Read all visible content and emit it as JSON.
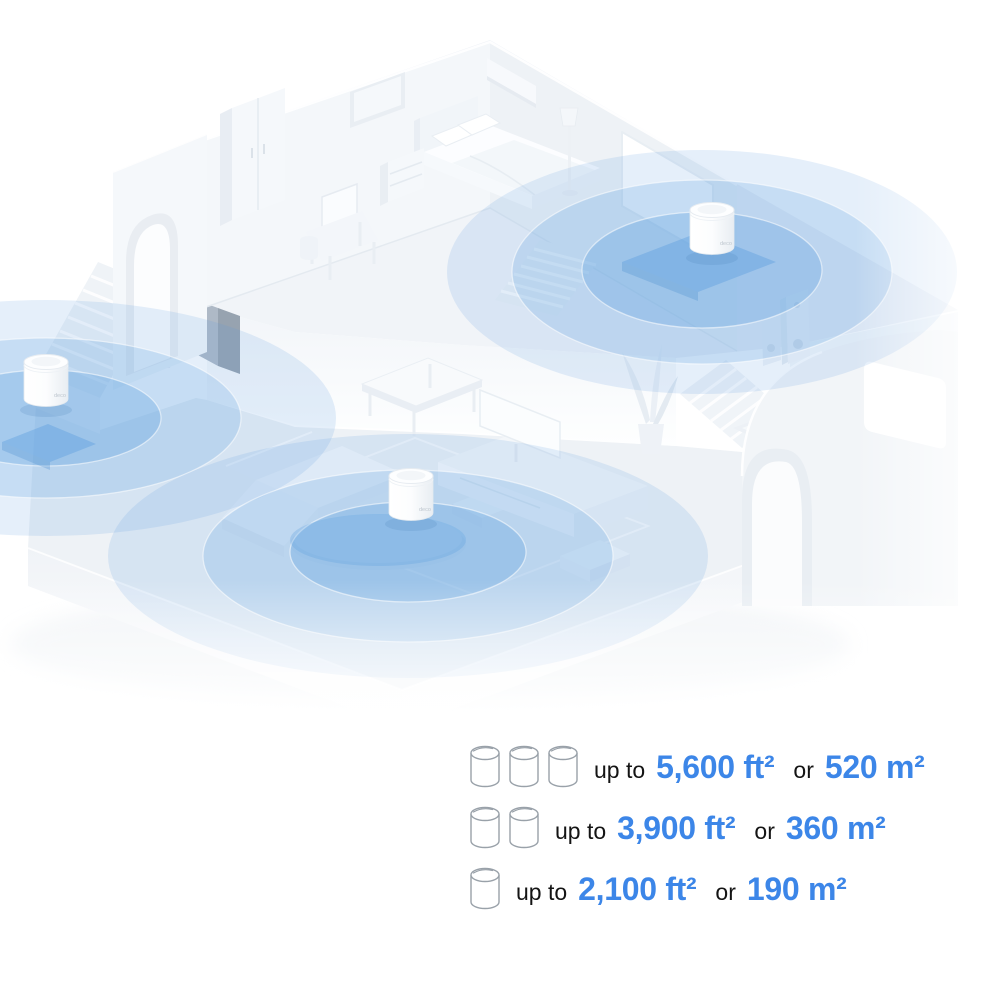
{
  "illustration": {
    "router_logo": "deco",
    "router_count": 3
  },
  "legend": {
    "rows": [
      {
        "units": 3,
        "prefix": "up to",
        "imperial": "5,600 ft²",
        "conjunction": "or",
        "metric": "520 m²"
      },
      {
        "units": 2,
        "prefix": "up to",
        "imperial": "3,900 ft²",
        "conjunction": "or",
        "metric": "360 m²"
      },
      {
        "units": 1,
        "prefix": "up to",
        "imperial": "2,100 ft²",
        "conjunction": "or",
        "metric": "190 m²"
      }
    ]
  },
  "colors": {
    "accent_blue": "#3C86E8",
    "coverage_blue": "#5B9EDE",
    "text_dark": "#141414",
    "icon_outline": "#99A1A9",
    "house_light": "#F1F4F8"
  }
}
